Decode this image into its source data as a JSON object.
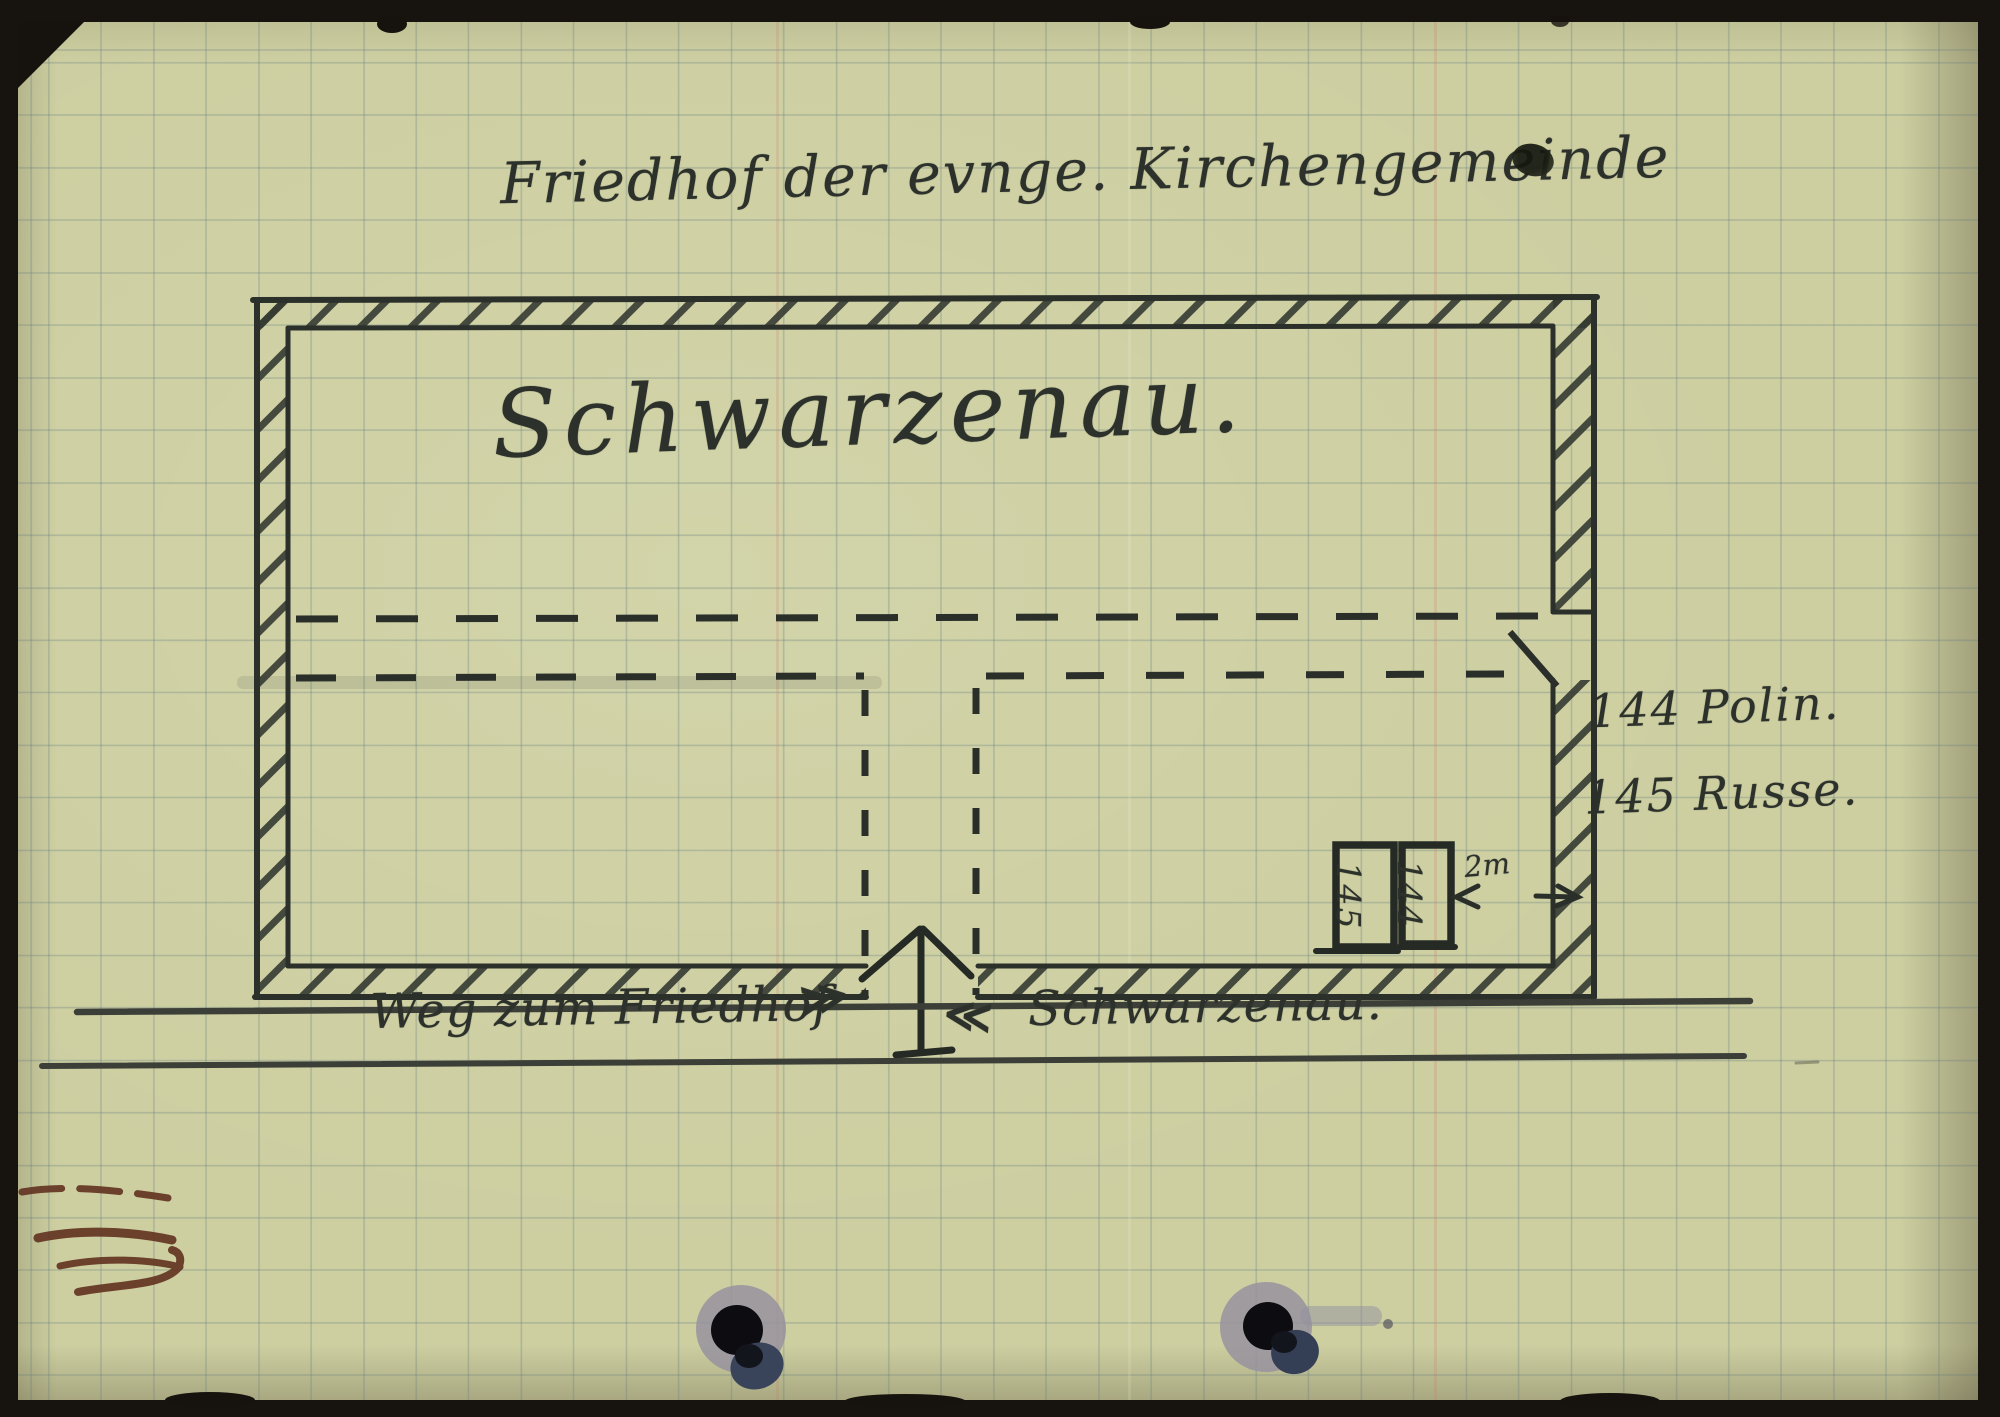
{
  "document": {
    "title": "Friedhof der evnge. Kirchengemeinde",
    "area_label": "Schwarzenau.",
    "legend": {
      "items": [
        {
          "number": "144",
          "label": "Polin."
        },
        {
          "number": "145",
          "label": "Russe."
        }
      ]
    },
    "graves": {
      "box_left_number": "145",
      "box_right_number": "144",
      "dimension_label": "2m"
    },
    "road": {
      "left_label": "Weg zum Friedhof",
      "left_arrows": "≫",
      "right_arrows": "≪",
      "right_label": "Schwarzenau."
    },
    "colors": {
      "paper": "#cdcfa1",
      "grid_line": "#627a7e",
      "pencil": "#2d312b",
      "crayon_mark": "#5f2e1d",
      "scan_background": "#17130e",
      "punch_hole_halo": "#97929f"
    }
  }
}
